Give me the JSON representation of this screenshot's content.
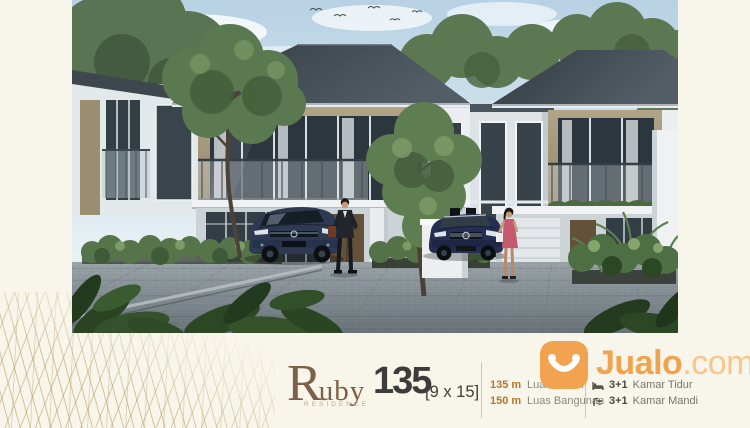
{
  "branding": {
    "name_initial": "R",
    "name_rest": "uby",
    "subtitle": "RESIDENCE",
    "type_number": "135",
    "dimension": "[9 x 15]"
  },
  "specs": {
    "land_value": "135 m",
    "land_label": "Luas Tanah",
    "building_value": "150 m",
    "building_label": "Luas Bangunan",
    "bedroom_value": "3+1",
    "bedroom_label": "Kamar Tidur",
    "bathroom_value": "3+1",
    "bathroom_label": "Kamar Mandi"
  },
  "watermark": {
    "brand": "Jualo",
    "suffix": ".com"
  },
  "icons": {
    "bedroom": "bed-icon",
    "bathroom": "shower-icon",
    "watermark": "smile-bag-icon"
  },
  "colors": {
    "background_cream": "#F8F5EA",
    "gold_line": "#B09A60",
    "brand_brown": "#7B6149",
    "text_dark": "#3C3C3A",
    "value_orange": "#B5762C",
    "label_gray": "#8B887C",
    "jualo_orange": "#F2A34F",
    "jualo_light": "#F7C58E",
    "roof_slate": "#3A4147",
    "wall_tan": "#A2947A",
    "car_navy": "#2D3A52"
  }
}
